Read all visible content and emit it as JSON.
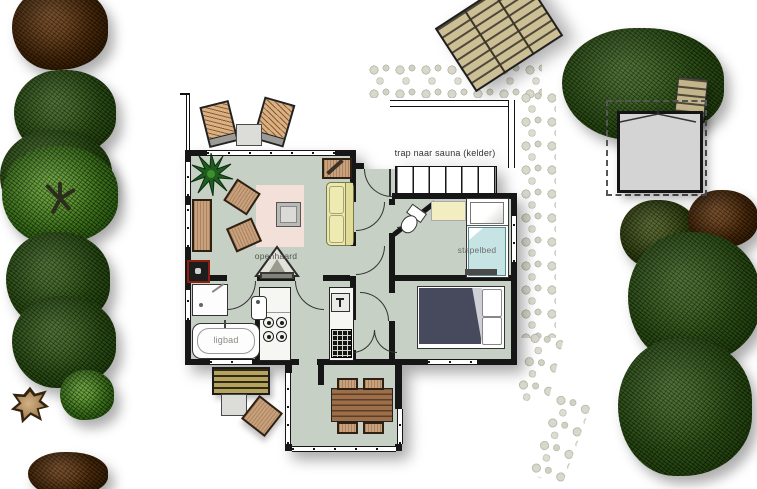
{
  "plan": {
    "labels": {
      "stairs_to_sauna": "trap naar sauna (kelder)",
      "fireplace": "openhaard",
      "bunk_bed": "stapelbed",
      "bathtub": "ligbad"
    },
    "colors": {
      "wall": "#161616",
      "floor": "#c6d0c4",
      "rug": "#f3e1d9",
      "sofa": "#ebe8ab",
      "bed_duvet": "#474a5c",
      "bunk_mattress": "#c6e4e3",
      "sleep_mat": "#f2eec1",
      "wood_furniture": "#c8a27e",
      "boiler_red": "#8e1d12",
      "pebble_path": "#cfcfc1",
      "deck_wood": "#c9bc93",
      "tree_dark_green": "#2d4d17",
      "tree_bright_green": "#4a8a22",
      "tree_brown": "#50300f",
      "stump": "#c3a376",
      "sauna_building": "#d4d4d4"
    }
  }
}
